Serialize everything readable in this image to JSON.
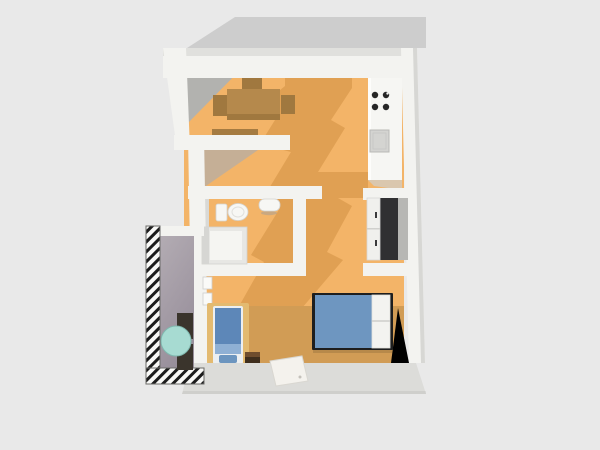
{
  "scene": {
    "description": "3D bird's-eye render of a small apartment floor plan on a plain light-gray background",
    "view": "top-down-3d",
    "canvas": {
      "width": 600,
      "height": 450
    }
  },
  "colors": {
    "background": "#e9e9e9",
    "cast-shadow": "#cdcdcd",
    "wall": "#f3f3f0",
    "wall-top": "#e0e0dd",
    "wall-edge": "#d7d7d4",
    "wall-shade": "#b2b2af",
    "corridor-shade": "#b5aea6",
    "floor": "#f3b468",
    "floor-shadow": "#e0a053",
    "floor-bedroom": "#d19c55",
    "inner-wall-face": "#dcdcd9",
    "counter": "#f6f6f3",
    "burner": "#262626",
    "sink": "#d4d4d1",
    "wardrobe": "#303032",
    "bed-frame": "#1e1e1e",
    "bed-blanket": "#6e96c0",
    "bed-pillow": "#f3f3f0",
    "lounger": "#5d87b8",
    "lounger-pillow": "#8fb0d4",
    "lounger-mat": "#e3ba70",
    "dining-wood": "#b5894c",
    "dining-wood-dark": "#a0783f",
    "balcony-floor-light": "#b3acb3",
    "balcony-floor-dark": "#988f9b",
    "balcony-table": "#a7dbd2",
    "balcony-chair": "#3a342c",
    "stool": "#3f2e1d",
    "stool-top": "#6f4d2e",
    "rug": "#f4f2ed",
    "hatch-bg": "#f8f8f6",
    "hatch-stripe": "#1c1c1c"
  },
  "rooms": [
    {
      "id": "dining-nook",
      "label": "dining nook (top-left, table with three chairs)"
    },
    {
      "id": "kitchen",
      "label": "kitchen strip (top-right, counter with cooktop and sink)"
    },
    {
      "id": "bathroom",
      "label": "bathroom (middle-left: toilet, wash basin, shower cabin)"
    },
    {
      "id": "hallway",
      "label": "open hallway between nook and bathroom"
    },
    {
      "id": "living-sleeping-area",
      "label": "main living / sleeping room (bottom)"
    },
    {
      "id": "balcony",
      "label": "balcony (left, hatched railing, gray deck)"
    }
  ],
  "furniture": [
    {
      "id": "dining-table",
      "room": "dining-nook"
    },
    {
      "id": "dining-chair-top",
      "room": "dining-nook"
    },
    {
      "id": "dining-chair-left",
      "room": "dining-nook"
    },
    {
      "id": "dining-chair-right",
      "room": "dining-nook"
    },
    {
      "id": "wall-shelf",
      "room": "dining-nook"
    },
    {
      "id": "kitchen-counter",
      "room": "kitchen"
    },
    {
      "id": "cooktop-burners",
      "room": "kitchen",
      "count": 4
    },
    {
      "id": "kitchen-sink",
      "room": "kitchen"
    },
    {
      "id": "toilet",
      "room": "bathroom"
    },
    {
      "id": "bathroom-sink",
      "room": "bathroom"
    },
    {
      "id": "shower-cabin",
      "room": "bathroom"
    },
    {
      "id": "wardrobe",
      "room": "living-sleeping-area",
      "note": "dark unit recessed in right wall niche, white doors with handles"
    },
    {
      "id": "double-bed",
      "room": "living-sleeping-area",
      "note": "blue blanket, two white pillows at right, dark head/foot rails"
    },
    {
      "id": "daybed",
      "room": "living-sleeping-area",
      "note": "blue single lounger on tan mat near balcony door"
    },
    {
      "id": "side-stool",
      "room": "living-sleeping-area"
    },
    {
      "id": "floor-rug",
      "room": "living-sleeping-area",
      "note": "white rug at bottom center"
    },
    {
      "id": "balcony-table",
      "room": "balcony",
      "note": "round teal table"
    },
    {
      "id": "balcony-chair-upper",
      "room": "balcony"
    },
    {
      "id": "balcony-chair-lower",
      "room": "balcony"
    },
    {
      "id": "balcony-door",
      "room": "living-sleeping-area"
    }
  ],
  "balcony": {
    "railing_pattern": "diagonal-hatch",
    "rail_sides": [
      "left",
      "bottom"
    ]
  }
}
